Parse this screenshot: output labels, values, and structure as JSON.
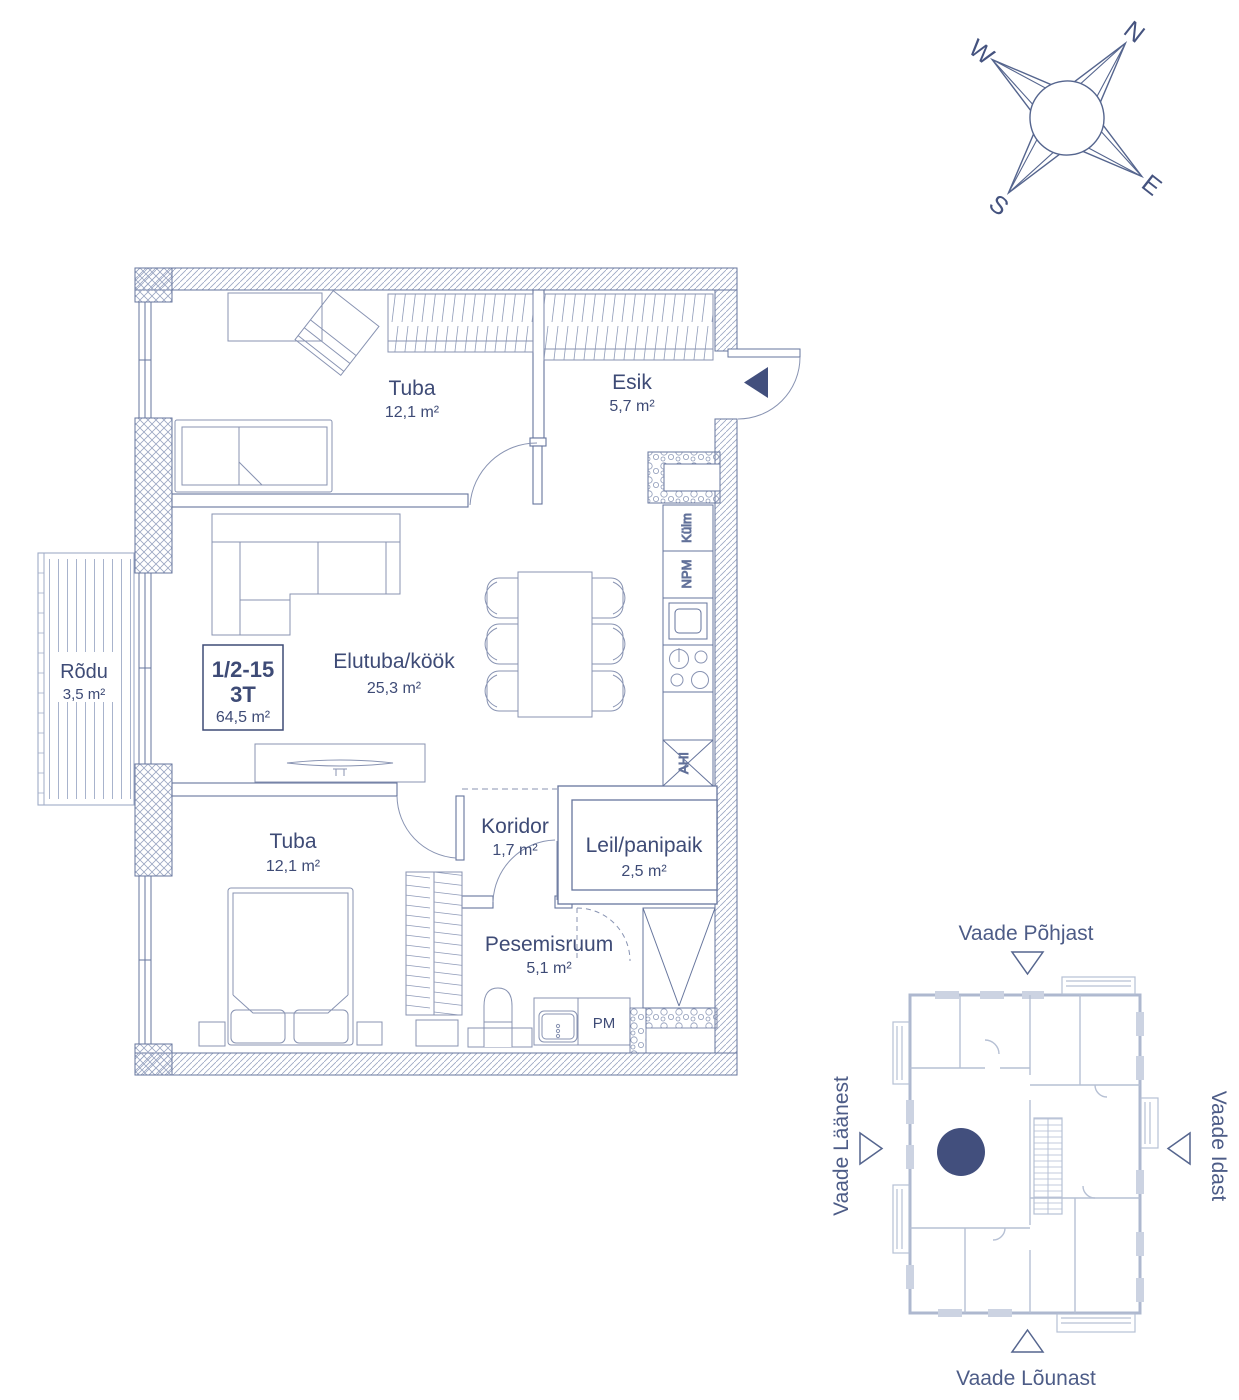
{
  "colors": {
    "ink": "#3e4b76",
    "accent_dark": "#424f7d",
    "wall_line": "#66759d",
    "furniture_line": "#8893b2",
    "site_plan_line": "#aeb8cf"
  },
  "compass": {
    "n": "N",
    "e": "E",
    "s": "S",
    "w": "W"
  },
  "unit_label": {
    "number": "1/2-15",
    "type": "3T",
    "area": "64,5 m²"
  },
  "rooms": {
    "tuba1": {
      "name": "Tuba",
      "area": "12,1 m²"
    },
    "esik": {
      "name": "Esik",
      "area": "5,7 m²"
    },
    "elutuba": {
      "name": "Elutuba/köök",
      "area": "25,3 m²"
    },
    "rodu": {
      "name": "Rõdu",
      "area": "3,5 m²"
    },
    "tuba2": {
      "name": "Tuba",
      "area": "12,1 m²"
    },
    "koridor": {
      "name": "Koridor",
      "area": "1,7 m²"
    },
    "leil": {
      "name": "Leil/panipaik",
      "area": "2,5 m²"
    },
    "pesemisruum": {
      "name": "Pesemisruum",
      "area": "5,1 m²"
    }
  },
  "appliances": {
    "fridge": "Külm",
    "dishwasher": "NPM",
    "oven": "AHI",
    "washing_machine": "PM"
  },
  "site_plan": {
    "view_north": "Vaade Põhjast",
    "view_south": "Vaade Lõunast",
    "view_west": "Vaade Läänest",
    "view_east": "Vaade Idast"
  }
}
